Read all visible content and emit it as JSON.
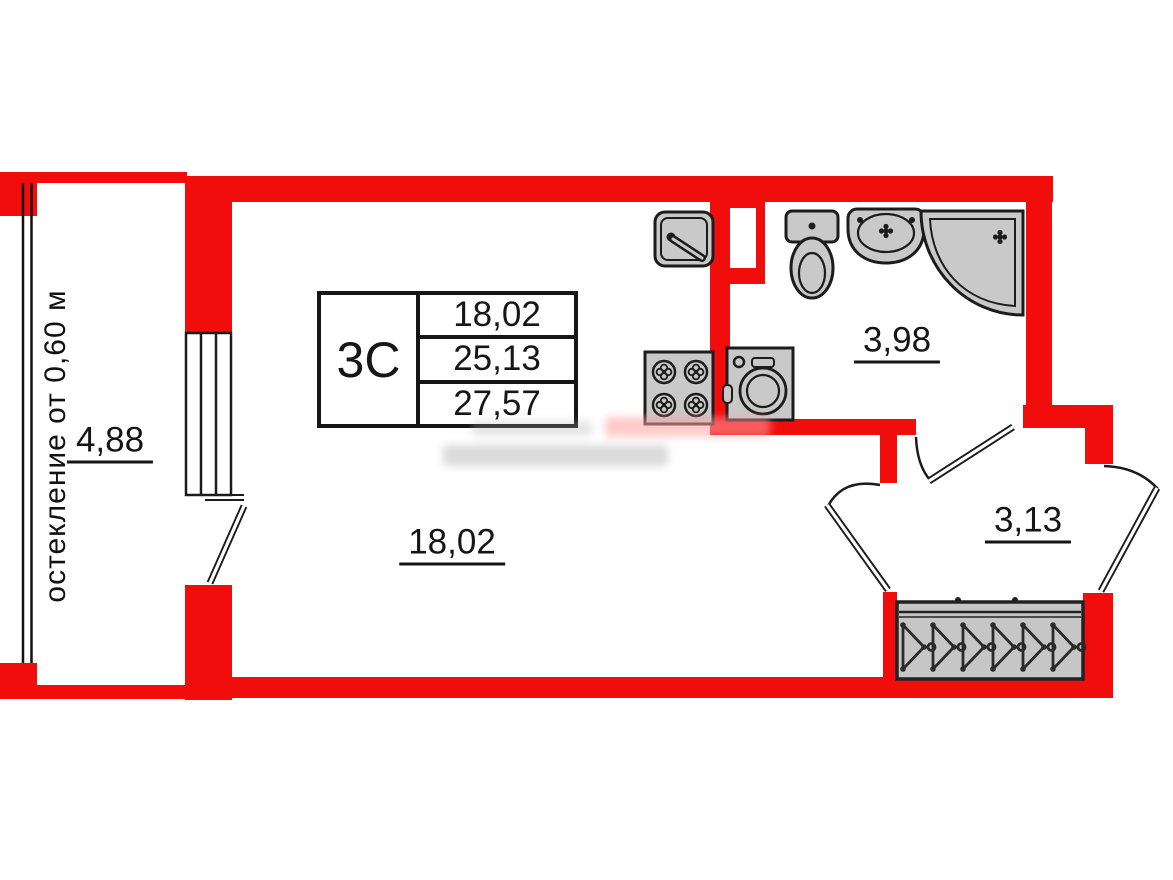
{
  "plan": {
    "unit_label": "3С",
    "areas": {
      "living": "18,02",
      "total": "25,13",
      "overall": "27,57"
    },
    "rooms": {
      "main_room": "18,02",
      "bathroom": "3,98",
      "hallway": "3,13",
      "balcony": "4,88"
    },
    "balcony_note": "остекление от 0,60 м",
    "colors": {
      "wall": "#f20d0d",
      "line": "#1c1c1c",
      "fixture_fill": "#c9c9c9"
    },
    "fixtures": [
      "kitchen-sink",
      "stove",
      "washing-machine",
      "toilet",
      "washbasin",
      "corner-shower",
      "wardrobe-with-hangers"
    ]
  }
}
